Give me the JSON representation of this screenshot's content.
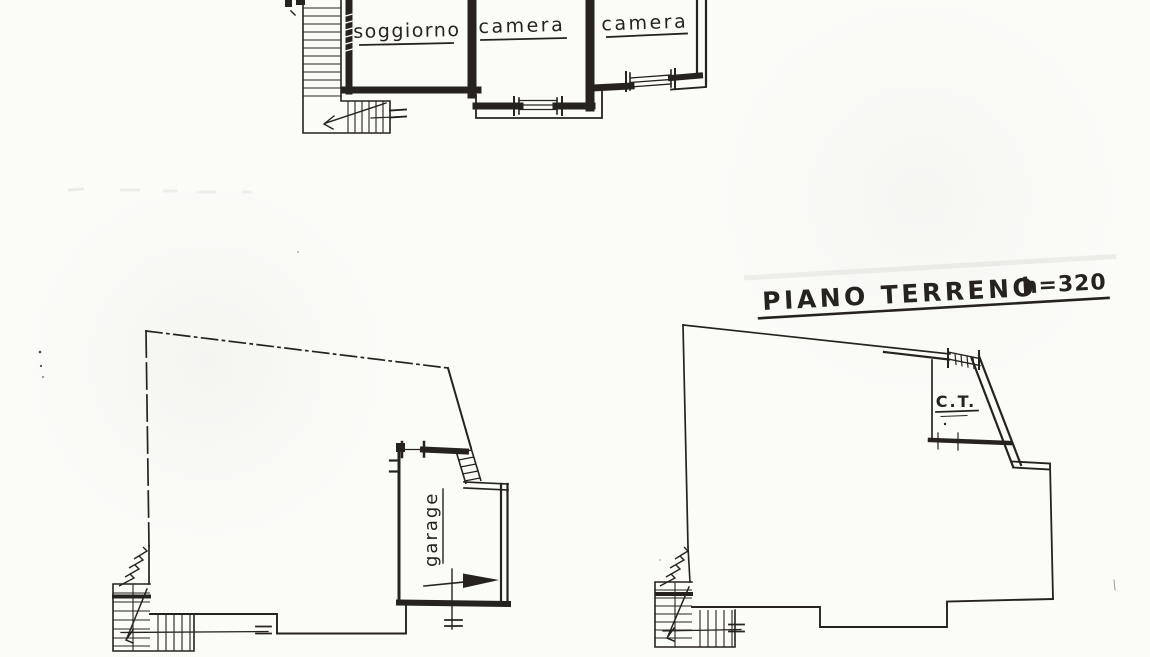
{
  "colors": {
    "paper": "#fbfbf8",
    "ink": "#26231f"
  },
  "title": {
    "text": "PIANO TERRENO",
    "height": "h=320"
  },
  "rooms": {
    "soggiorno": "soggiorno",
    "camera_1": "camera",
    "camera_2": "camera",
    "garage": "garage",
    "boiler": "C.T."
  }
}
